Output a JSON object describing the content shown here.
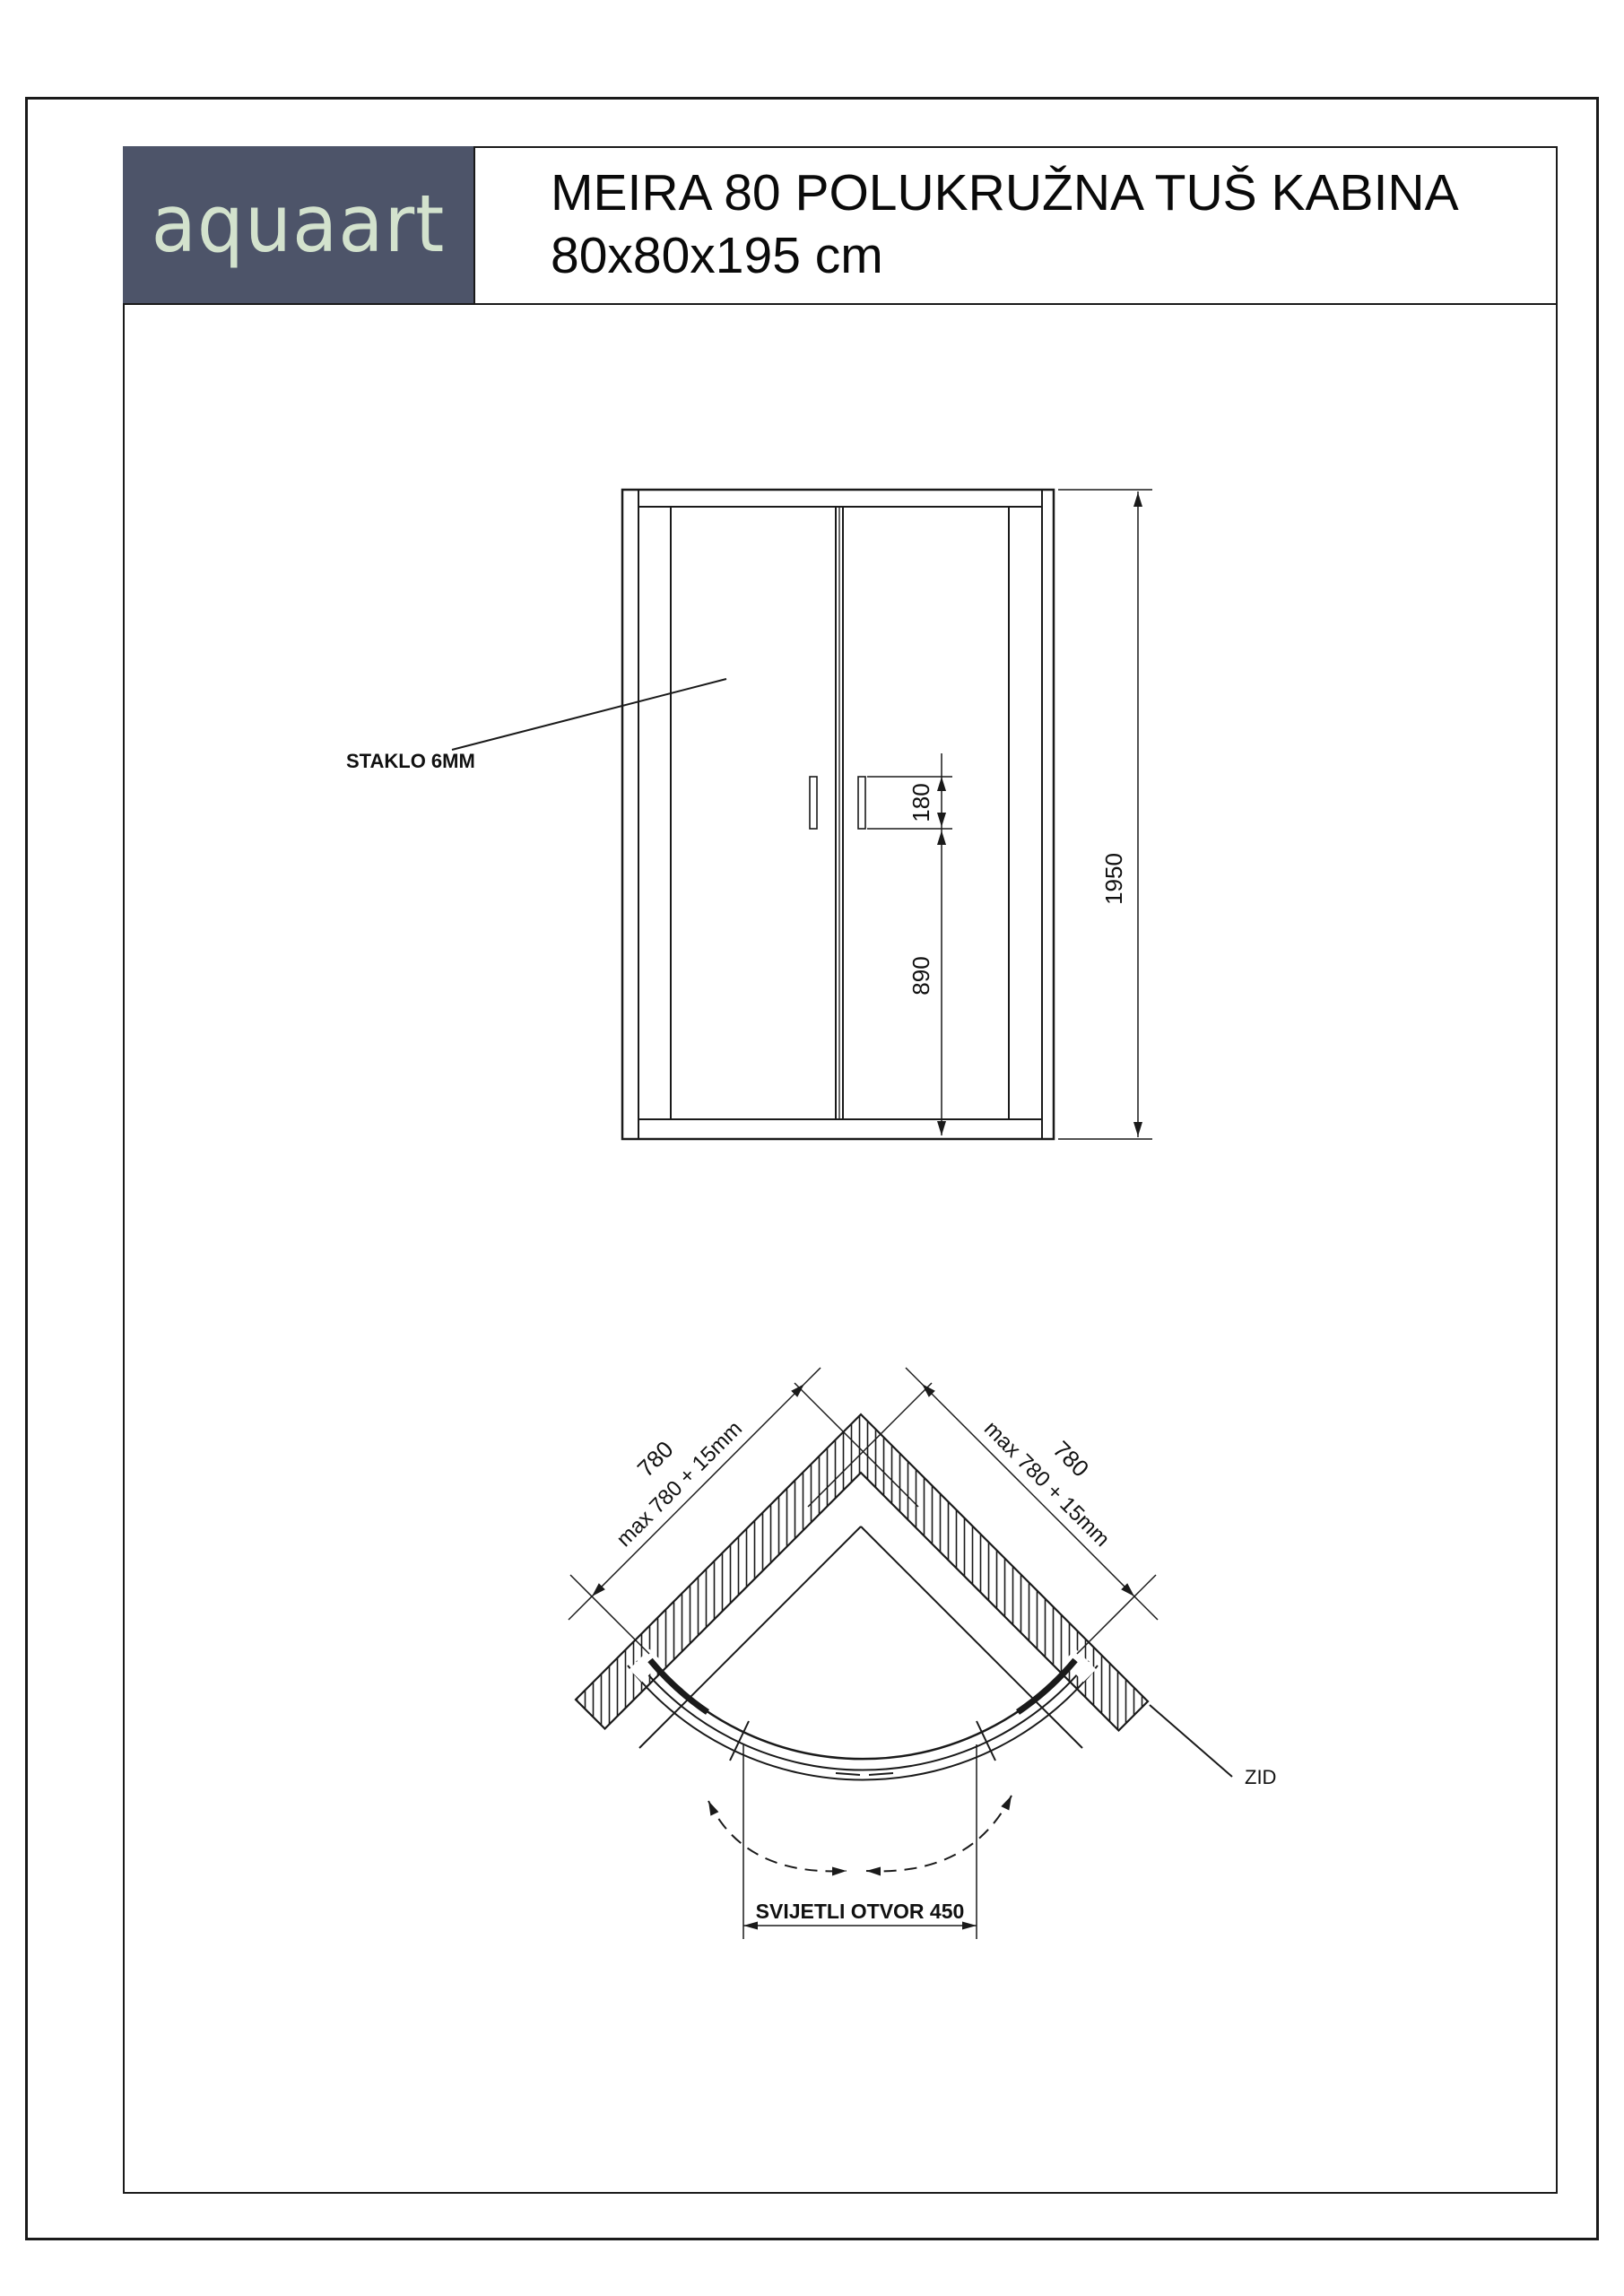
{
  "header": {
    "logo_text": "aquaart",
    "title_line1": "MEIRA 80 POLUKRUŽNA TUŠ KABINA",
    "title_line2": "80x80x195 cm"
  },
  "front_view": {
    "glass_label": "STAKLO 6MM",
    "dim_total_height": "1950",
    "dim_handle_length": "180",
    "dim_handle_height": "890"
  },
  "plan_view": {
    "dim_left_wall": "780",
    "dim_left_wall_max": "max 780 + 15mm",
    "dim_right_wall": "780",
    "dim_right_wall_max": "max 780 + 15mm",
    "wall_label": "ZID",
    "dim_clear_opening": "SVIJETLI OTVOR 450"
  },
  "colors": {
    "logo_bg": "#4d5469",
    "logo_text": "#d3e2cd",
    "line": "#1a1a1a"
  }
}
